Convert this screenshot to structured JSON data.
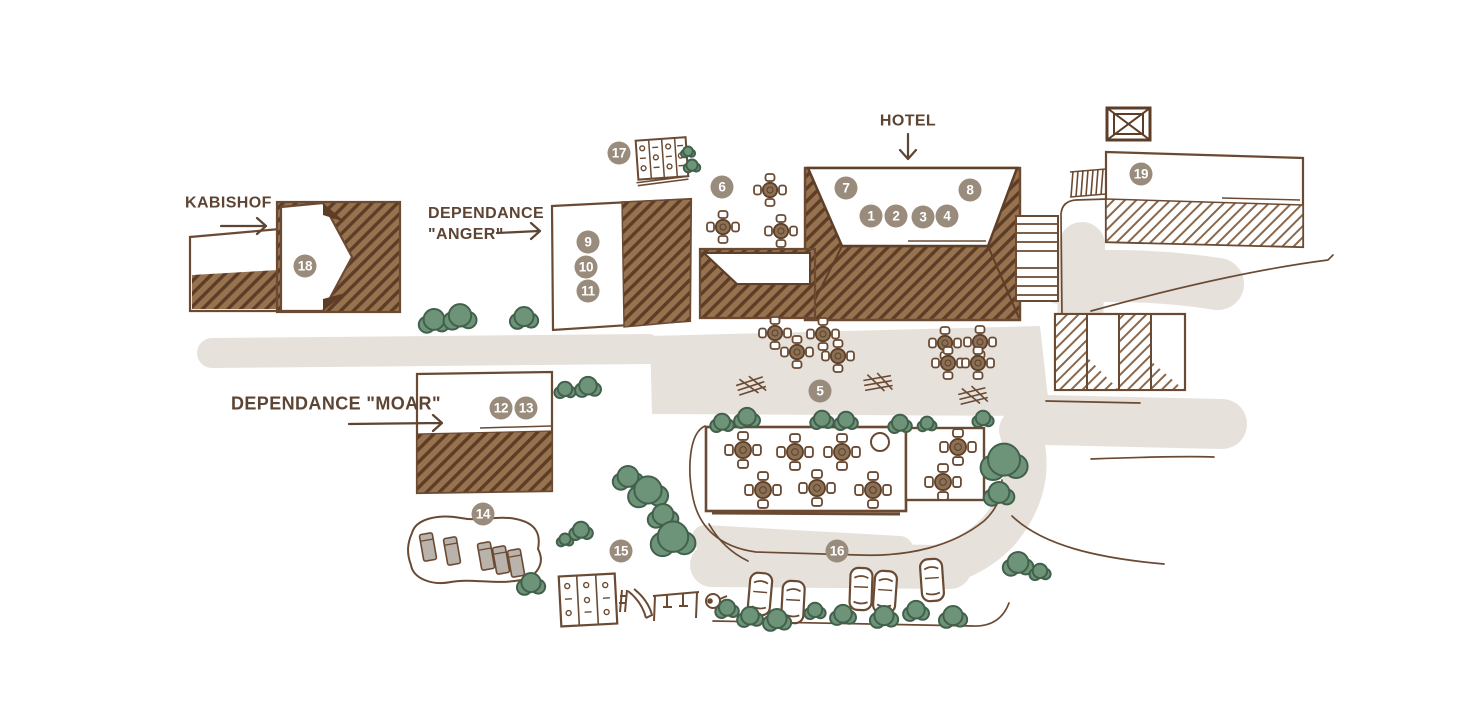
{
  "labels": {
    "hotel": "HOTEL",
    "kabishof": "KABISHOF",
    "anger_line1": "DEPENDANCE",
    "anger_line2": "\"ANGER\"",
    "moar": "DEPENDANCE \"MOAR\""
  },
  "markers": [
    {
      "number": "1",
      "x": 871,
      "y": 216
    },
    {
      "number": "2",
      "x": 896,
      "y": 216
    },
    {
      "number": "3",
      "x": 923,
      "y": 217
    },
    {
      "number": "4",
      "x": 947,
      "y": 216
    },
    {
      "number": "5",
      "x": 820,
      "y": 391
    },
    {
      "number": "6",
      "x": 722,
      "y": 187
    },
    {
      "number": "7",
      "x": 846,
      "y": 188
    },
    {
      "number": "8",
      "x": 970,
      "y": 190
    },
    {
      "number": "9",
      "x": 588,
      "y": 242
    },
    {
      "number": "10",
      "x": 586,
      "y": 267
    },
    {
      "number": "11",
      "x": 588,
      "y": 291
    },
    {
      "number": "12",
      "x": 501,
      "y": 408
    },
    {
      "number": "13",
      "x": 526,
      "y": 408
    },
    {
      "number": "14",
      "x": 483,
      "y": 514
    },
    {
      "number": "15",
      "x": 621,
      "y": 551
    },
    {
      "number": "16",
      "x": 837,
      "y": 551
    },
    {
      "number": "17",
      "x": 619,
      "y": 153
    },
    {
      "number": "18",
      "x": 305,
      "y": 266
    },
    {
      "number": "19",
      "x": 1141,
      "y": 174
    }
  ],
  "colors": {
    "outline": "#6b4a33",
    "dark_stroke": "#5e3f28",
    "roof_fill": "#97724f",
    "roof_stripe": "#5e3d27",
    "light_hatch_stripe": "#8a684c",
    "marker_fill": "#9a8c7c",
    "marker_text": "#ffffff",
    "label_text": "#5d4433",
    "tree_fill": "#6d9478",
    "tree_outline": "#42604b",
    "road_fill": "#e6e1da",
    "sunbed_fill": "#b9b3ab"
  }
}
